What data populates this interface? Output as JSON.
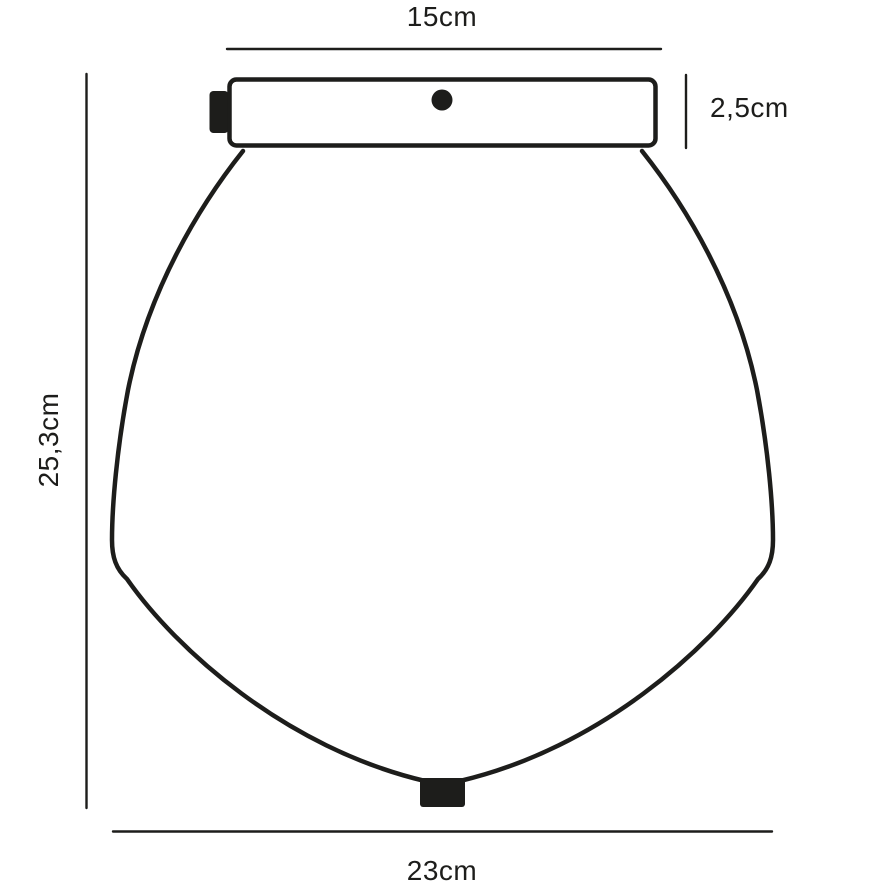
{
  "diagram": {
    "type": "product-dimension-drawing",
    "subject": "ceiling-lamp-with-glass-shade",
    "dimensions": {
      "top_width_label": "15cm",
      "canopy_height_label": "2,5cm",
      "total_height_label": "25,3cm",
      "shade_width_label": "23cm"
    },
    "colors": {
      "line": "#1d1d1b",
      "background": "#ffffff"
    }
  }
}
